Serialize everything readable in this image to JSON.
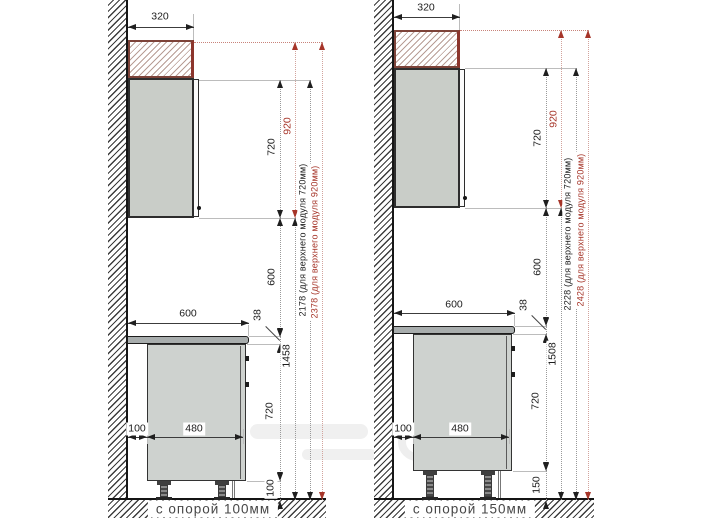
{
  "drawing": {
    "type": "kitchen cabinet mounting heights, side view",
    "colors": {
      "accent_red": "#a63529",
      "line": "#1f1f1f",
      "cabinet_fill": "#ced2cf",
      "counter_fill": "#a8adad"
    },
    "panels": [
      {
        "caption": "с опорой 100мм",
        "top_depth": "320",
        "counter_width": "600",
        "counter_thickness": "38",
        "wall_gap": "100",
        "base_depth": "480",
        "upper_height": "720",
        "upper_height_920": "920",
        "upper_gap": "600",
        "base_height": "720",
        "leg_height": "100",
        "floor_to_upper": "1458",
        "total_720": "2178 (для верхнего модуля 720мм)",
        "total_920": "2378 (для верхнего модуля 920мм)"
      },
      {
        "caption": "с опорой 150мм",
        "top_depth": "320",
        "counter_width": "600",
        "counter_thickness": "38",
        "wall_gap": "100",
        "base_depth": "480",
        "upper_height": "720",
        "upper_height_920": "920",
        "upper_gap": "600",
        "base_height": "720",
        "leg_height": "150",
        "floor_to_upper": "1508",
        "total_720": "2228 (для верхнего модуля 720мм)",
        "total_920": "2428 (для верхнего модуля 920мм)"
      }
    ]
  }
}
